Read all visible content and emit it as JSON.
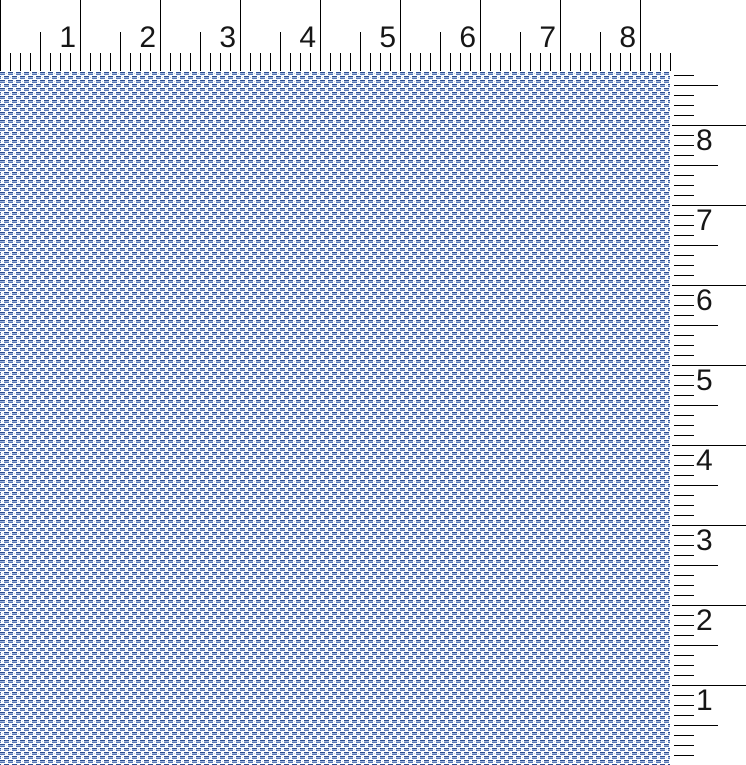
{
  "workspace": {
    "background": "#ffffff"
  },
  "rulers": {
    "tick_color": "#000000",
    "label_color": "#161616",
    "pixels_per_unit": 80,
    "subdivisions_per_unit": 8,
    "top": {
      "orientation": "horizontal",
      "labels": [
        "1",
        "2",
        "3",
        "4",
        "5",
        "6",
        "7",
        "8"
      ]
    },
    "right": {
      "orientation": "vertical",
      "labels": [
        "8",
        "7",
        "6",
        "5",
        "4",
        "3",
        "2",
        "1"
      ]
    }
  },
  "fabric": {
    "kind": "woven-fabric-simulation-swatch",
    "repeat_px": 8,
    "thread_colors": {
      "dash_dark": "#2d4d8f",
      "dash_light": "#9fb4da",
      "dash_mid": "#5878b6",
      "speckle": "#c7d2e4",
      "speckle_faint": "#e9edf5",
      "ground": "#fdfeff"
    }
  }
}
